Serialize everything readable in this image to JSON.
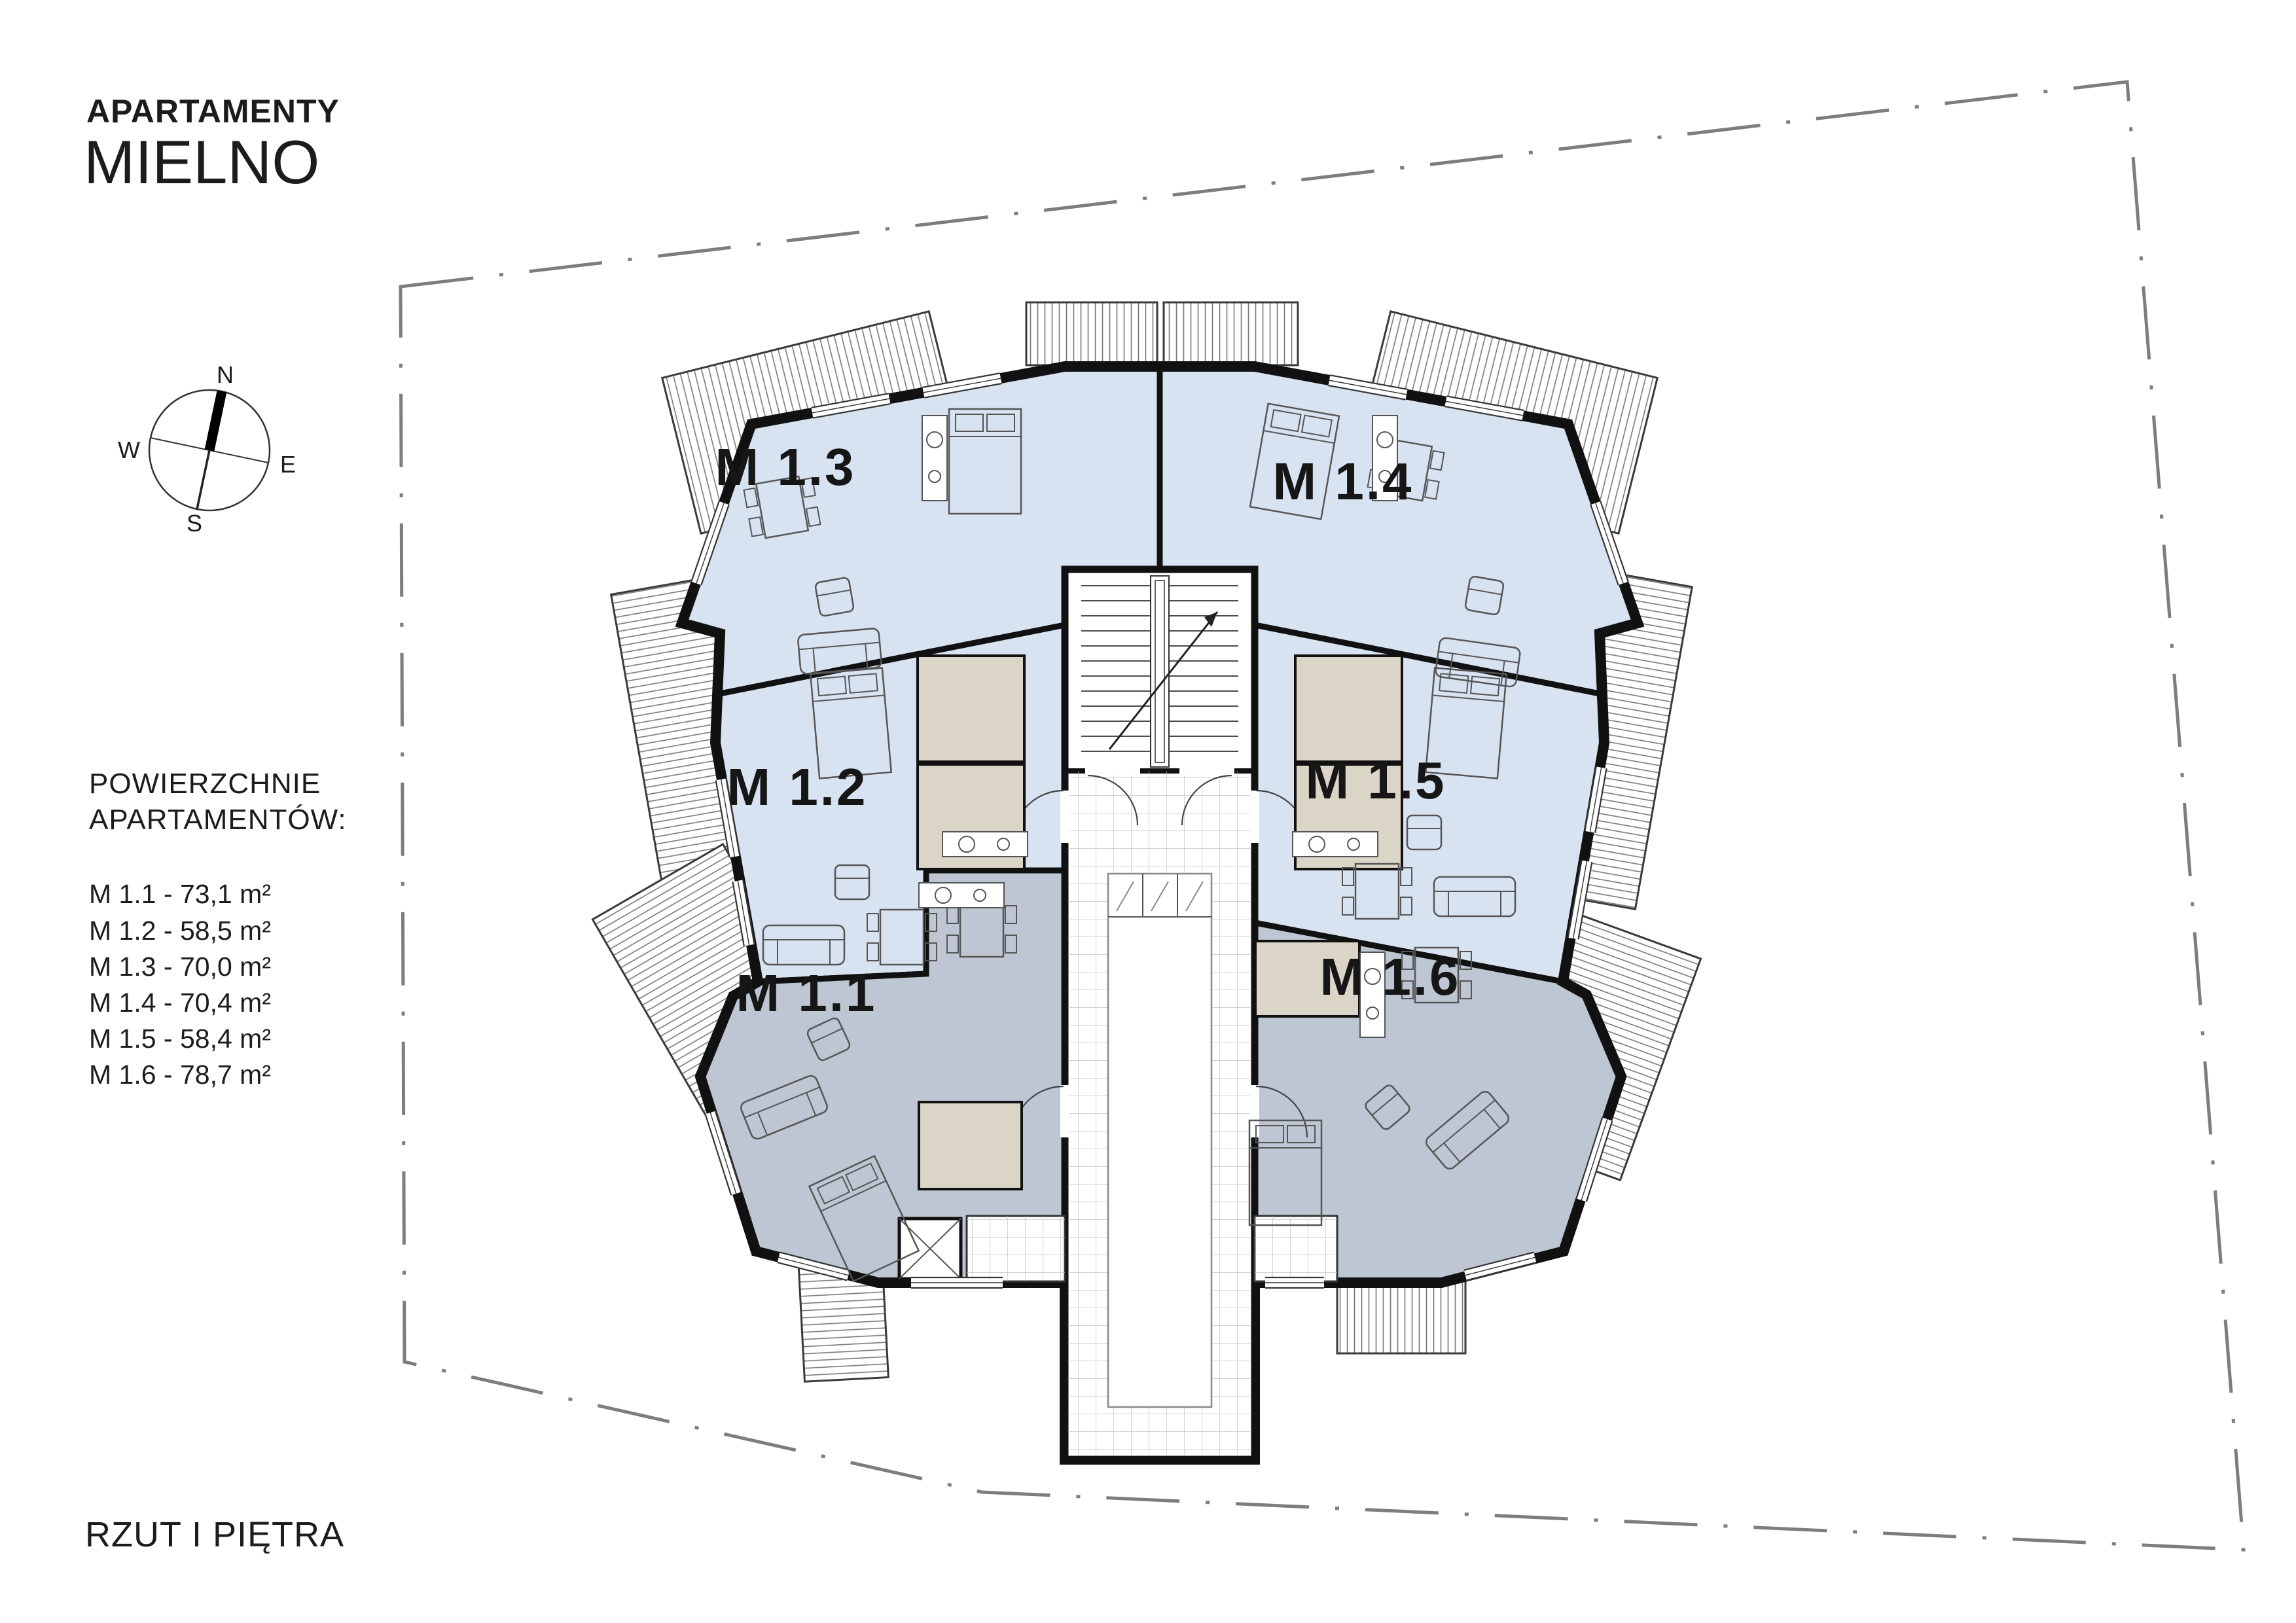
{
  "title": {
    "line1": "APARTAMENTY",
    "line2": "MIELNO"
  },
  "compass": {
    "n": "N",
    "e": "E",
    "s": "S",
    "w": "W"
  },
  "legend": {
    "heading_line1": "POWIERZCHNIE",
    "heading_line2": "APARTAMENTÓW:",
    "items": [
      "M 1.1 - 73,1 m²",
      "M 1.2 - 58,5 m²",
      "M 1.3 - 70,0 m²",
      "M 1.4 - 70,4 m²",
      "M 1.5 - 58,4 m²",
      "M 1.6 - 78,7 m²"
    ]
  },
  "footer": {
    "caption": "RZUT I PIĘTRA"
  },
  "plan": {
    "apartments": [
      {
        "id": "M1.1",
        "label": "M 1.1",
        "area_m2": "73,1"
      },
      {
        "id": "M1.2",
        "label": "M 1.2",
        "area_m2": "58,5"
      },
      {
        "id": "M1.3",
        "label": "M 1.3",
        "area_m2": "70,0"
      },
      {
        "id": "M1.4",
        "label": "M 1.4",
        "area_m2": "70,4"
      },
      {
        "id": "M1.5",
        "label": "M 1.5",
        "area_m2": "58,4"
      },
      {
        "id": "M1.6",
        "label": "M 1.6",
        "area_m2": "78,7"
      }
    ]
  },
  "colors": {
    "apartment_blue": "#d8e3f2",
    "apartment_gray": "#bdc6d2",
    "bathroom_beige": "#dbd5c7",
    "wall_black": "#111111",
    "boundary_gray": "#7d7d7d",
    "balcony_hatch": "#777777"
  }
}
